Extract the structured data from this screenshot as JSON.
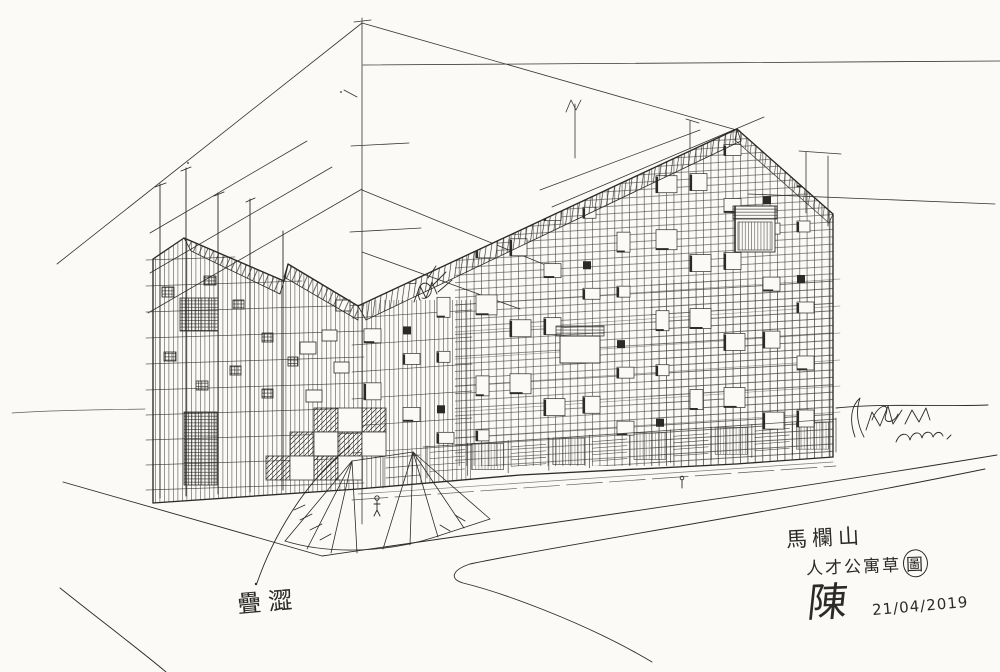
{
  "artwork": {
    "project_title": "馬欄山",
    "project_subtitle": "人才公寓草圖",
    "subtitle_plain": "人才公寓草",
    "subtitle_circled": "圖",
    "material_note": "疊澀",
    "signature": "陳",
    "date": "21/04/2019",
    "ink_color": "#2b2a27",
    "paper_color": "#fbfaf7"
  }
}
